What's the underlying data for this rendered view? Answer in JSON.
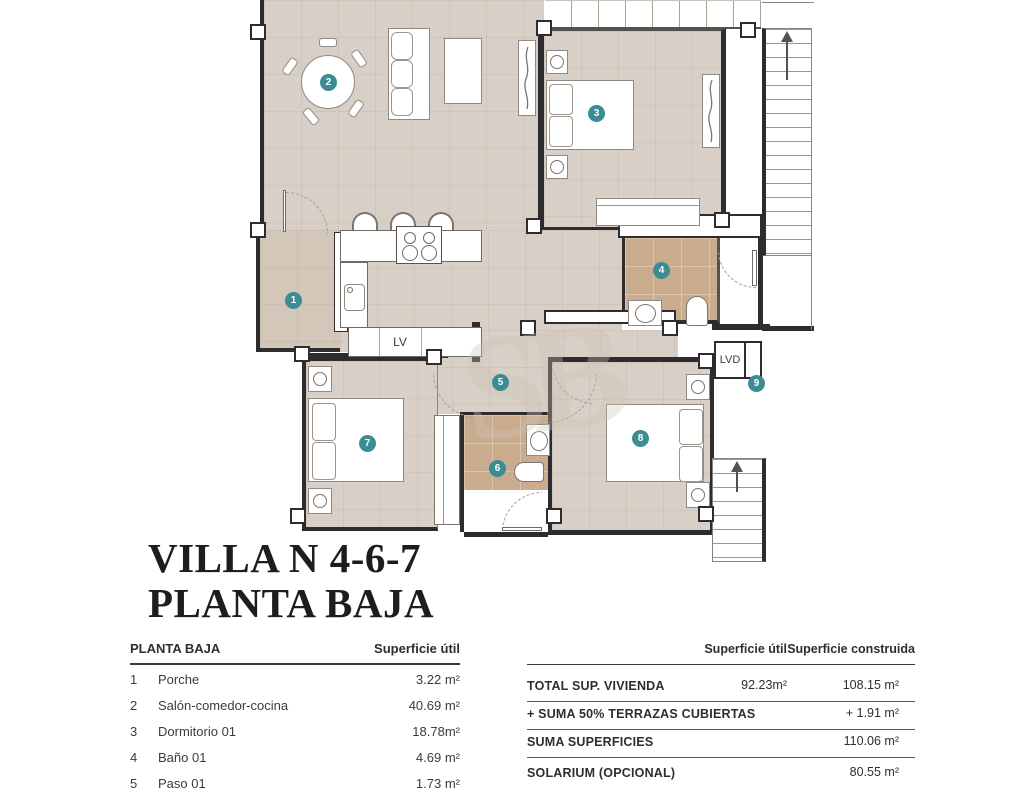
{
  "title": {
    "line1": "VILLA N 4-6-7",
    "line2": "PLANTA BAJA"
  },
  "plan": {
    "badges": [
      "1",
      "2",
      "3",
      "4",
      "5",
      "6",
      "7",
      "8",
      "9"
    ],
    "labels": {
      "dishwasher": "LV",
      "washer": "LVD"
    },
    "colors": {
      "floor": "#d8d0c6",
      "porch_floor": "#d2c7b9",
      "bath_floor": "#c9ac8e",
      "wall": "#2e2c2e",
      "badge": "#3c8d93"
    }
  },
  "tables": {
    "left": {
      "title": "PLANTA BAJA",
      "column": "Superficie útil",
      "rows": [
        {
          "num": "1",
          "name": "Porche",
          "value": "3.22 m²"
        },
        {
          "num": "2",
          "name": "Salón-comedor-cocina",
          "value": "40.69 m²"
        },
        {
          "num": "3",
          "name": "Dormitorio 01",
          "value": "18.78m²"
        },
        {
          "num": "4",
          "name": "Baño 01",
          "value": "4.69 m²"
        },
        {
          "num": "5",
          "name": "Paso 01",
          "value": "1.73 m²"
        }
      ]
    },
    "right": {
      "col1": "Superficie útil",
      "col2": "Superficie construida",
      "rows": [
        {
          "label": "TOTAL SUP. VIVIENDA",
          "util": "92.23m²",
          "built": "108.15 m²"
        },
        {
          "label": "+ SUMA 50% TERRAZAS CUBIERTAS",
          "util": "",
          "built": "+ 1.91 m²"
        },
        {
          "label": "SUMA SUPERFICIES",
          "util": "",
          "built": "110.06 m²"
        },
        {
          "label": "SOLARIUM (OPCIONAL)",
          "util": "",
          "built": "80.55 m²"
        }
      ]
    }
  }
}
